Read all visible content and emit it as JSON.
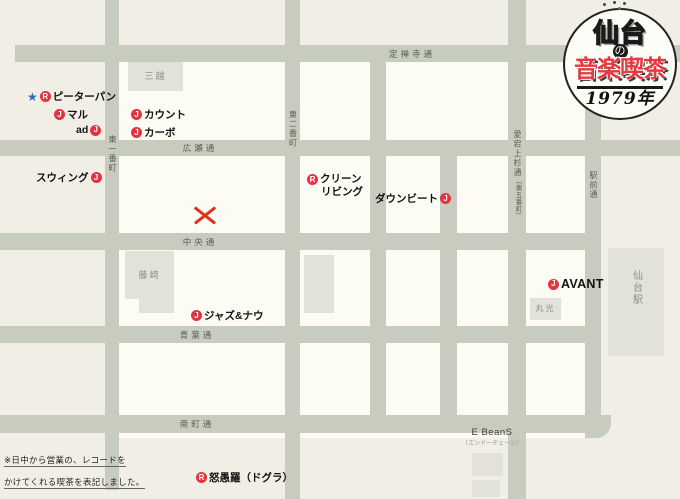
{
  "title_badge": {
    "city": "仙台",
    "particle": "の",
    "main": "音楽喫茶",
    "year": "1979年"
  },
  "note": {
    "line1": "※日中から営業の、レコードを",
    "line2": "かけてくれる喫茶を表記しました。"
  },
  "streets": {
    "jozenji": {
      "label": "定禅寺通"
    },
    "hirose": {
      "label": "広瀬通"
    },
    "chuo": {
      "label": "中央通"
    },
    "aoba": {
      "label": "青葉通"
    },
    "minamimachi": {
      "label": "南町通"
    },
    "higashi_ichibancho": {
      "label": "東一番町"
    },
    "higashi_nibancho": {
      "label": "東二番町"
    },
    "atago_kamisugi": {
      "label": "愛宕上杉通",
      "sub": "〔東五番町〕"
    },
    "ekimae": {
      "label": "駅前通"
    }
  },
  "buildings": {
    "mitsukoshi": {
      "label": "三越"
    },
    "fujisaki": {
      "label": "藤崎"
    },
    "marumitsu": {
      "label": "丸光"
    },
    "sendai_station": {
      "label": "仙台駅"
    },
    "ebeans": {
      "label": "E BeanS",
      "sub": "〔エンドーチェーン〕"
    }
  },
  "venues": [
    {
      "star": "★",
      "marker": "R",
      "name": "ピーターパン"
    },
    {
      "marker": "J",
      "name": "マル"
    },
    {
      "name": "ad",
      "marker": "J"
    },
    {
      "marker": "J",
      "name": "カウント"
    },
    {
      "marker": "J",
      "name": "カーボ"
    },
    {
      "name": "スウィング",
      "marker": "J"
    },
    {
      "marker": "R",
      "name": "クリーン",
      "name2": "リビング"
    },
    {
      "name": "ダウンビート",
      "marker": "J"
    },
    {
      "marker": "J",
      "name": "AVANT"
    },
    {
      "marker": "J",
      "name": "ジャズ&ナウ"
    },
    {
      "marker": "R",
      "name": "怒愚羅（ドグラ）"
    }
  ],
  "colors": {
    "paper": "#f1efe5",
    "block_white": "#fcfbf4",
    "street_gray": "#c8ccbf",
    "building_gray": "#e3e2d8",
    "marker_red": "#e23440",
    "badge_red": "#e5383f",
    "star_blue": "#2e6cb5",
    "x_red": "#e0301e"
  }
}
